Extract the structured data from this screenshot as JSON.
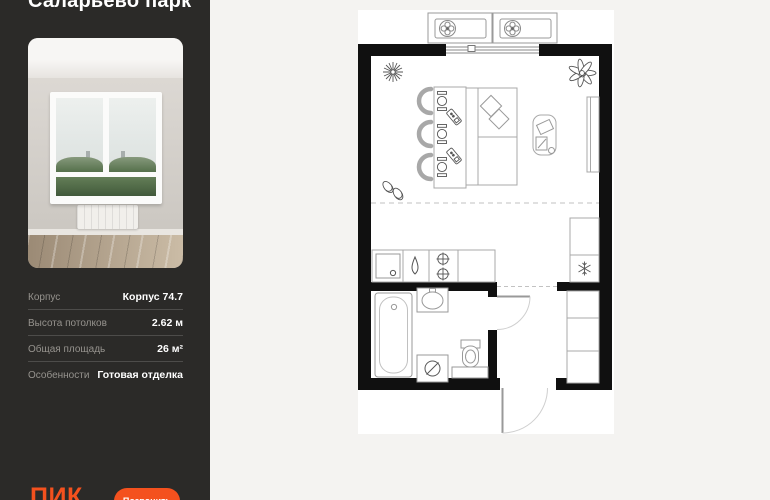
{
  "sidebar": {
    "title": "Саларьево парк",
    "specs": [
      {
        "label": "Корпус",
        "value": "Корпус 74.7"
      },
      {
        "label": "Высота потолков",
        "value": "2.62 м"
      },
      {
        "label": "Общая площадь",
        "value": "26 м²"
      },
      {
        "label": "Особенности",
        "value": "Готовая отделка"
      }
    ],
    "logo": "ПИК",
    "cta_label": "Позвонить"
  },
  "plan": {
    "icons": [
      "ac-fan-icon",
      "flower-icon",
      "plant-icon",
      "place-setting-icon",
      "phone-icon",
      "slippers-icon",
      "faucet-drop-icon",
      "burner-icon",
      "snowflake-icon",
      "washing-machine-icon"
    ]
  },
  "colors": {
    "accent": "#f4511e",
    "sidebar_bg": "#2b2a28",
    "page_bg": "#f4f3f1",
    "wall": "#101010"
  }
}
